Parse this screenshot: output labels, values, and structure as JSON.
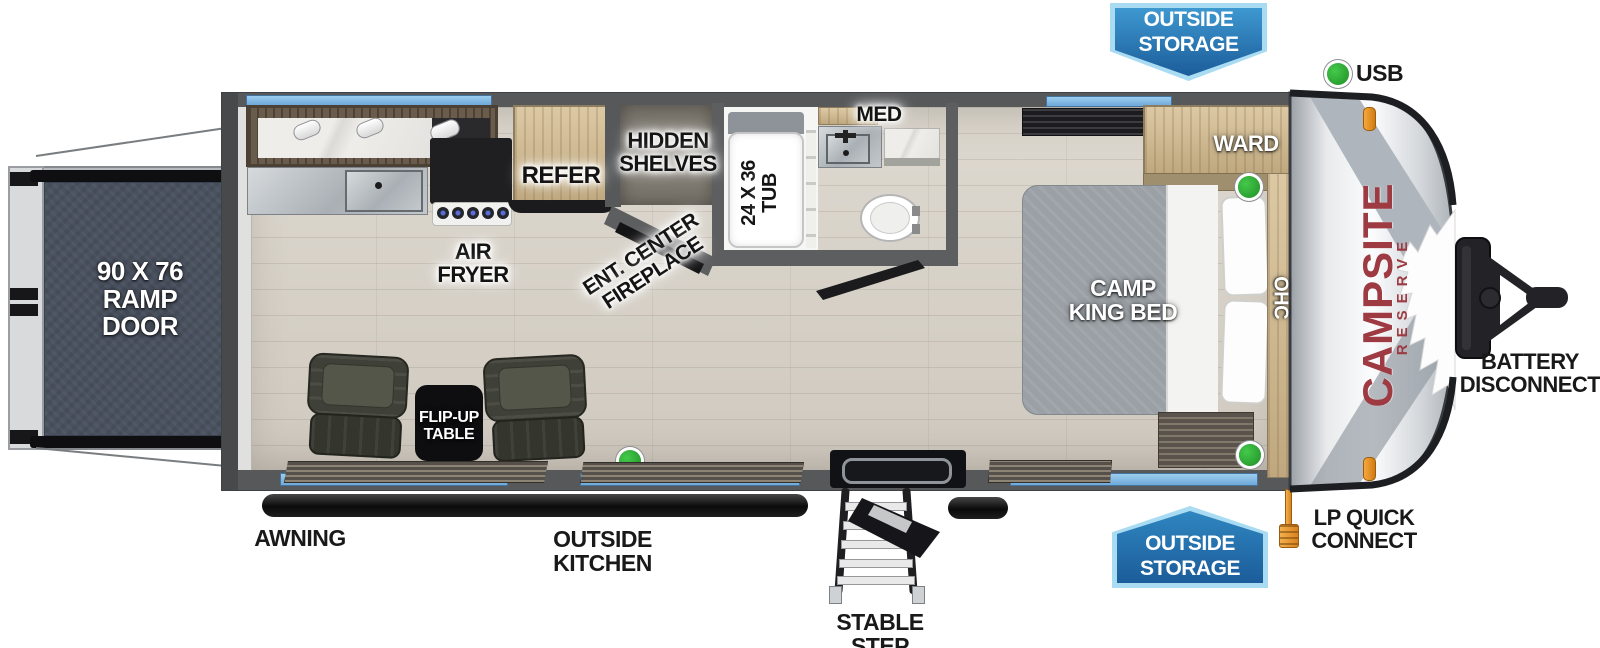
{
  "title": "Campsite Reserve Travel Trailer Floorplan",
  "legend": {
    "usb": "USB"
  },
  "badges": {
    "outside_storage_top": {
      "line1": "OUTSIDE",
      "line2": "STORAGE"
    },
    "outside_storage_bottom": {
      "line1": "OUTSIDE",
      "line2": "STORAGE"
    }
  },
  "exterior": {
    "awning": "AWNING",
    "outside_kitchen": {
      "line1": "OUTSIDE",
      "line2": "KITCHEN"
    },
    "stable_step": "STABLE STEP",
    "lp_quick_connect": {
      "line1": "LP QUICK",
      "line2": "CONNECT"
    },
    "battery_disconnect": {
      "line1": "BATTERY",
      "line2": "DISCONNECT"
    }
  },
  "interior": {
    "ramp_door": {
      "line1": "90 X 76",
      "line2": "RAMP",
      "line3": "DOOR"
    },
    "air_fryer": {
      "line1": "AIR",
      "line2": "FRYER"
    },
    "refer": "REFER",
    "hidden_shelves": {
      "line1": "HIDDEN",
      "line2": "SHELVES"
    },
    "ent_center_fireplace": {
      "line1": "ENT. CENTER",
      "line2": "FIREPLACE"
    },
    "tub": {
      "line1": "24 X 36",
      "line2": "TUB"
    },
    "med": "MED",
    "camp_king_bed": {
      "line1": "CAMP",
      "line2": "KING BED"
    },
    "ward": "WARD",
    "ohc": "OHC",
    "flip_up_table": {
      "line1": "FLIP-UP",
      "line2": "TABLE"
    }
  },
  "brand": {
    "name": "CAMPSITE",
    "series": "RESERVE"
  },
  "colors": {
    "badge_border": "#a9dcf3",
    "badge_blue_top": "#3e98d0",
    "badge_blue_bottom": "#1b5c9a",
    "window_blue": "#86bfe9",
    "usb_green": "#2ba32f",
    "brand_red": "#9e3a42",
    "lp_orange": "#e79a2d",
    "wall_gray": "#57585a",
    "floor_wood": "#d8d3ca",
    "ramp_door_fill": "#4a5260"
  }
}
